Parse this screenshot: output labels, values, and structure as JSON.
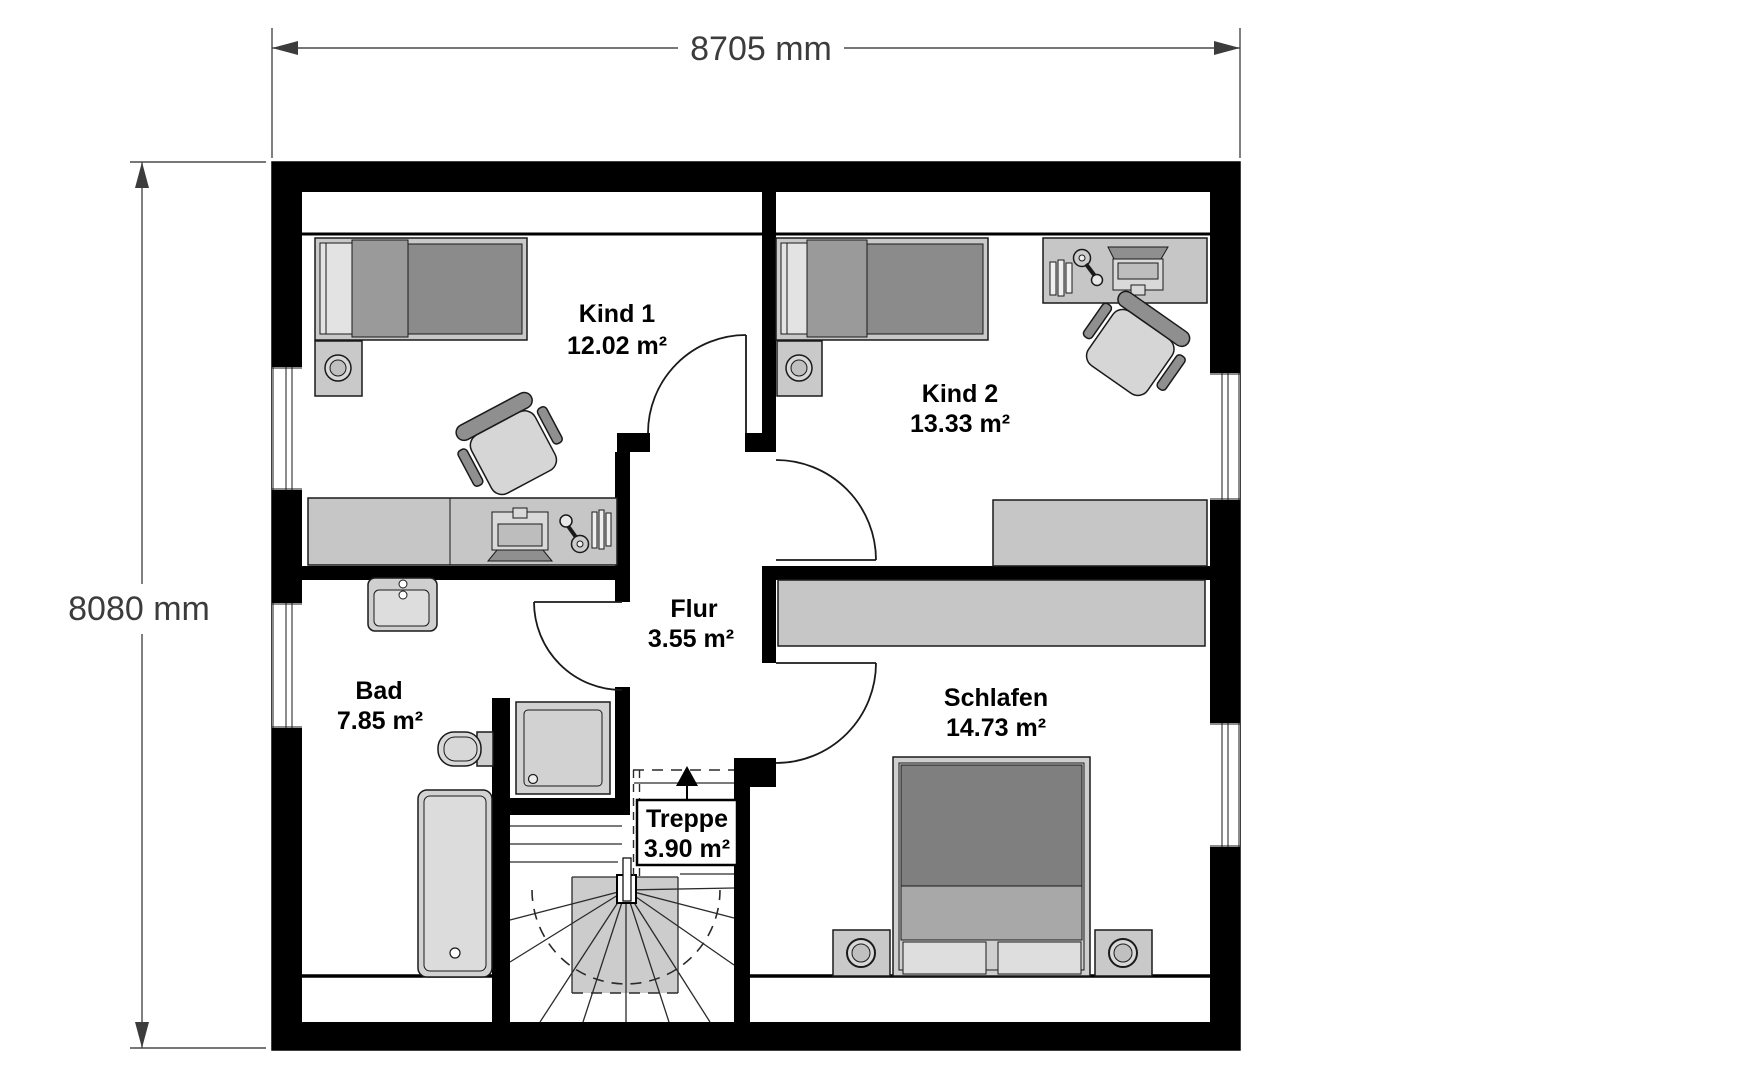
{
  "plan": {
    "type": "floor-plan",
    "floor": "attic storey (bedrooms, bath, stair)",
    "dimensions": {
      "width_label": "8705 mm",
      "height_label": "8080 mm"
    },
    "rooms": {
      "kind1": {
        "name": "Kind 1",
        "area": "12.02 m²"
      },
      "kind2": {
        "name": "Kind 2",
        "area": "13.33 m²"
      },
      "flur": {
        "name": "Flur",
        "area": "3.55 m²"
      },
      "bad": {
        "name": "Bad",
        "area": "7.85 m²"
      },
      "treppe": {
        "name": "Treppe",
        "area": "3.90 m²"
      },
      "schlafen": {
        "name": "Schlafen",
        "area": "14.73 m²"
      }
    },
    "colors": {
      "background": "#ffffff",
      "wall": "#000000",
      "furniture_light": "#c9c9c9",
      "furniture_medium": "#a8a8a8",
      "furniture_dark": "#8b8b8b",
      "bed_blanket_dark": "#7f7f7f",
      "dimension_text": "#3c3c3c"
    }
  }
}
